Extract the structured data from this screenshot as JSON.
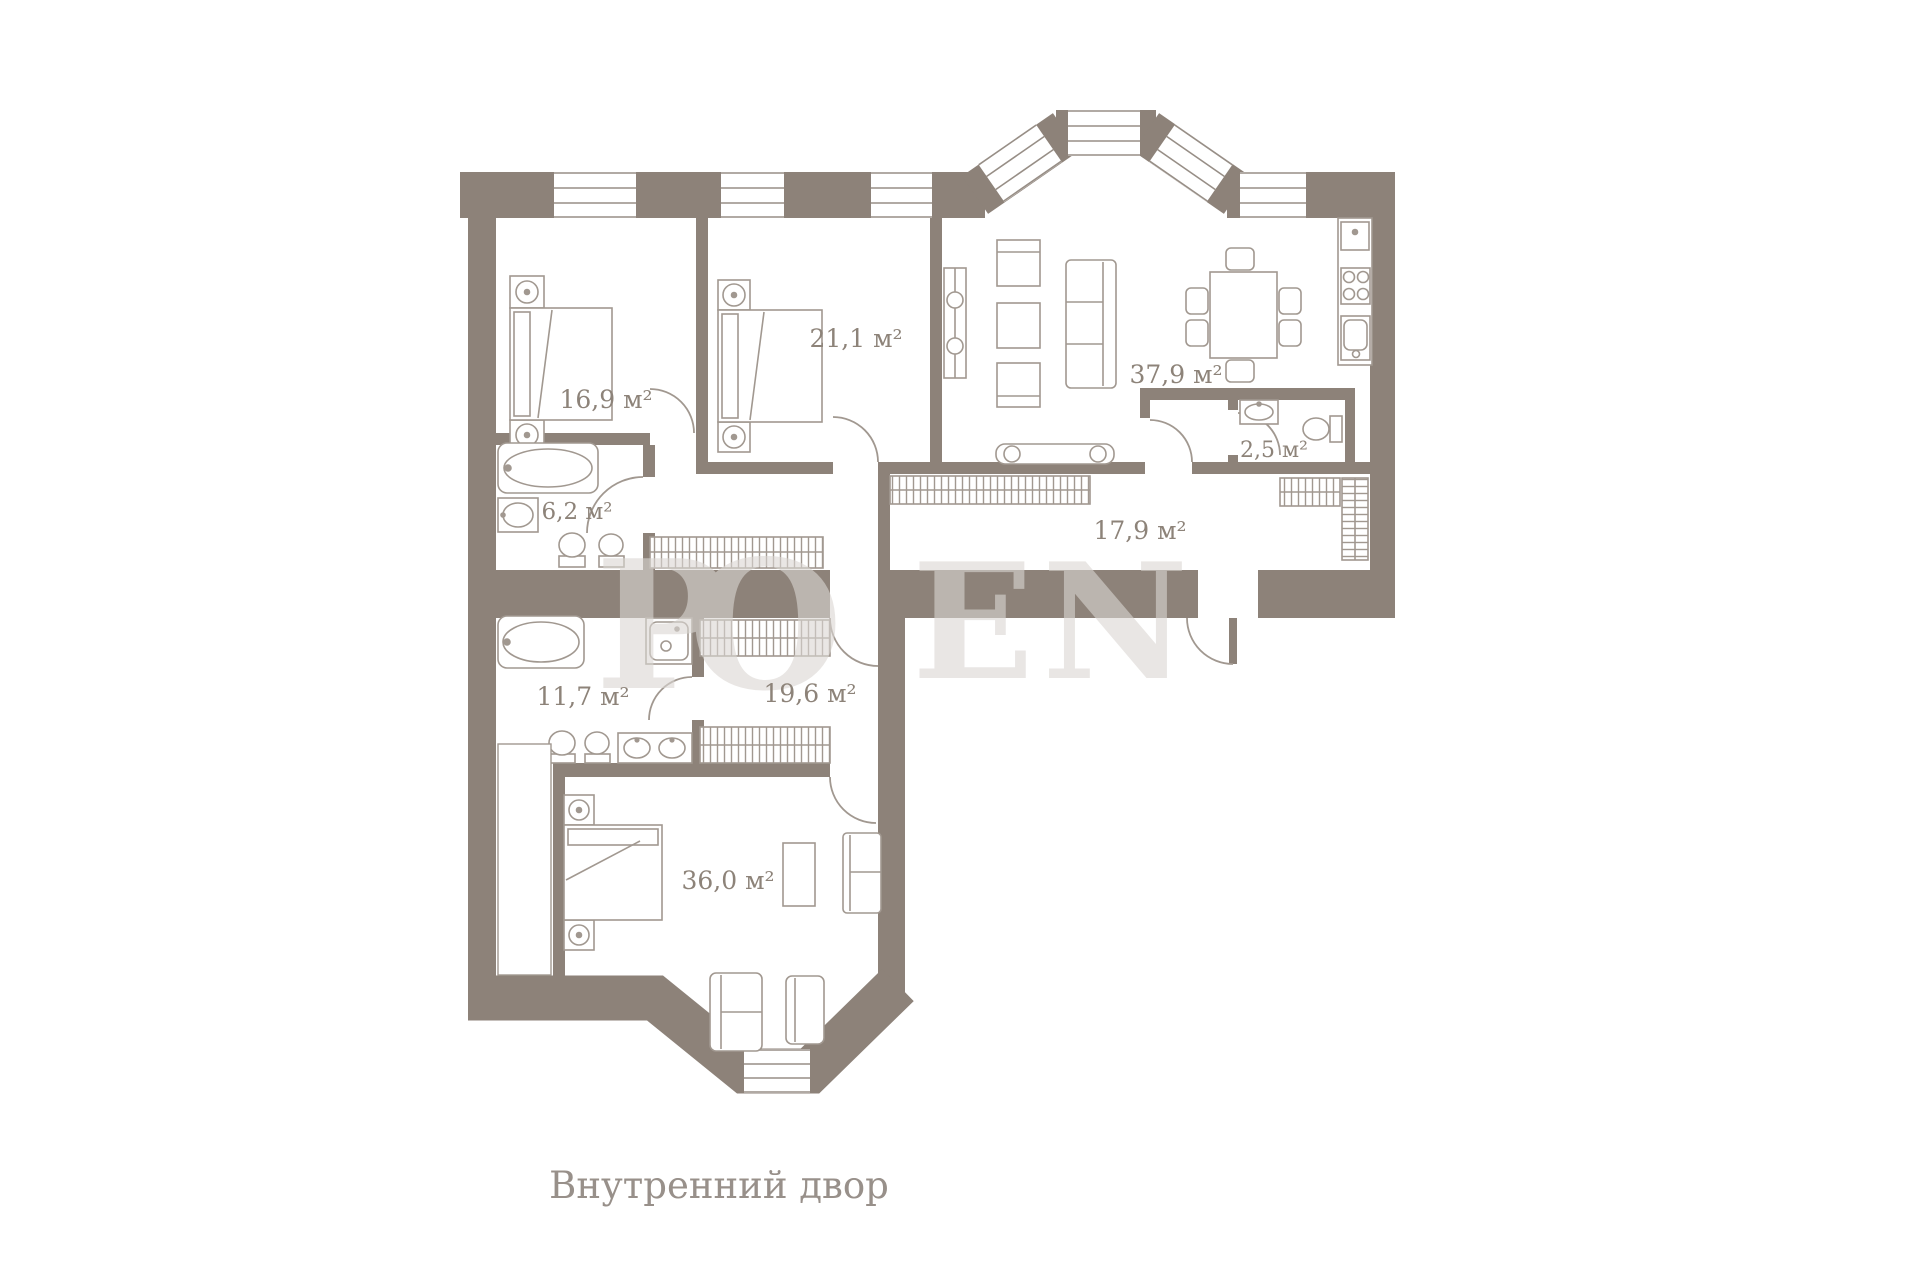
{
  "palette": {
    "wall": "#8d8279",
    "furniture_line": "#a19890",
    "window_line": "#978e86",
    "label": "#8d8379",
    "watermark": "#dbd7d3",
    "background": "#ffffff"
  },
  "floor_plan": {
    "rooms": [
      {
        "id": "bedroom-1",
        "area_label": "16,9 м²"
      },
      {
        "id": "bedroom-2",
        "area_label": "21,1 м²"
      },
      {
        "id": "kitchen-living",
        "area_label": "37,9 м²"
      },
      {
        "id": "wc",
        "area_label": "2,5 м²"
      },
      {
        "id": "bathroom-1",
        "area_label": "6,2 м²"
      },
      {
        "id": "hallway",
        "area_label": "17,9 м²"
      },
      {
        "id": "bathroom-2",
        "area_label": "11,7 м²"
      },
      {
        "id": "dressing",
        "area_label": "19,6 м²"
      },
      {
        "id": "bedroom-3",
        "area_label": "36,0 м²"
      }
    ],
    "captions": {
      "courtyard": "Внутренний двор"
    },
    "watermark": {
      "l1": "Р",
      "l2": "О",
      "l3": "Е",
      "l4": "N"
    }
  }
}
